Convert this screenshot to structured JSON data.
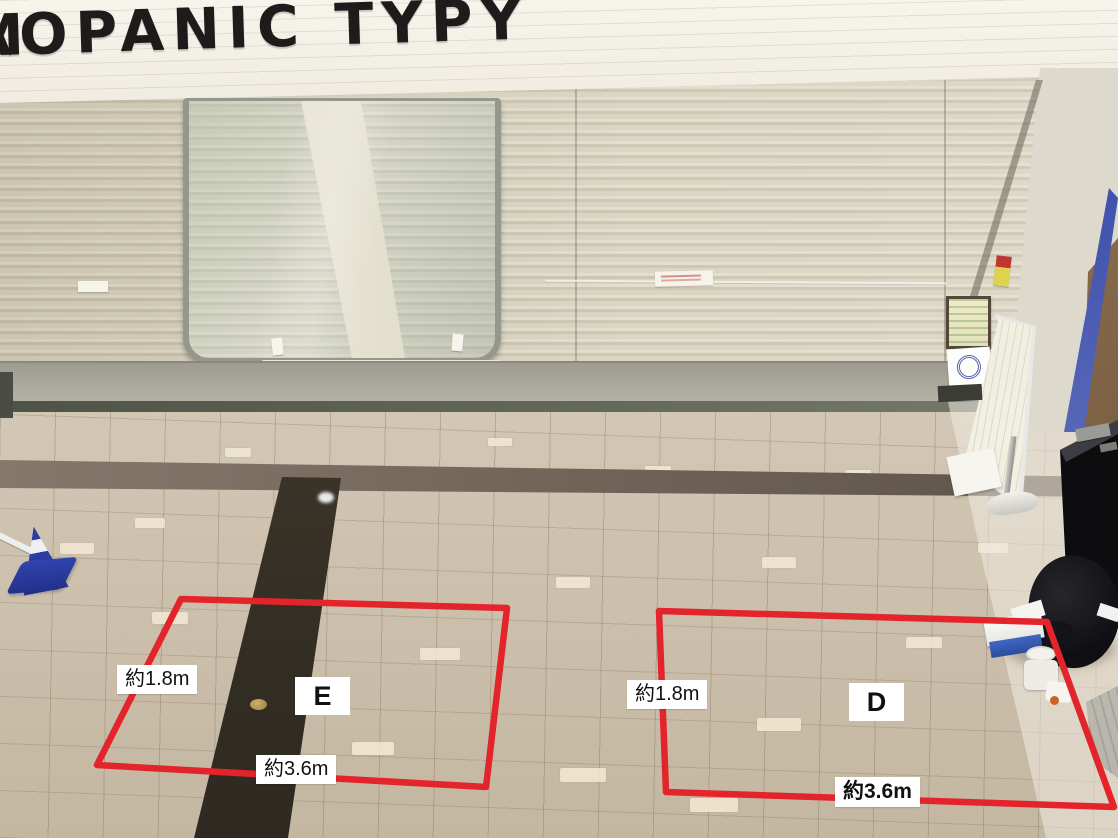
{
  "storefront": {
    "sign_partial_letter": "M",
    "sign_text": "AOPANIC TYPY"
  },
  "zones": [
    {
      "id": "E",
      "label": "E",
      "depth_label": "約1.8m",
      "width_label": "約3.6m"
    },
    {
      "id": "D",
      "label": "D",
      "depth_label": "約1.8m",
      "width_label": "約3.6m"
    }
  ],
  "colors": {
    "zone_outline_red": "#e3242b",
    "label_background": "#ffffff",
    "label_text": "#111111",
    "sign_letters": "#1d1c1a",
    "shutter_beige": "#d8d2bf",
    "floor_tile": "#cdc1ac",
    "dark_band_brown": "#352f25",
    "cone_blue": "#2c3da8"
  }
}
